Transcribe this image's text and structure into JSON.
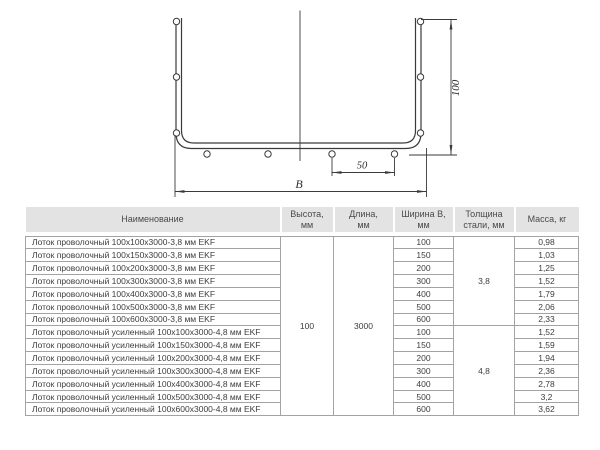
{
  "diagram": {
    "height_label": "100",
    "spacing_label": "50",
    "width_label": "B"
  },
  "table": {
    "headers": {
      "name": "Наименование",
      "height": "Высота,\nмм",
      "length": "Длина,\nмм",
      "width": "Ширина В,\nмм",
      "thickness": "Толщина\nстали, мм",
      "mass": "Масса, кг"
    },
    "shared": {
      "height_mm": "100",
      "length_mm": "3000",
      "thickness_groups": [
        "3,8",
        "4,8"
      ]
    },
    "rows": [
      {
        "name": "Лоток проволочный 100x100x3000-3,8 мм EKF",
        "width": "100",
        "mass": "0,98"
      },
      {
        "name": "Лоток проволочный 100x150x3000-3,8 мм EKF",
        "width": "150",
        "mass": "1,03"
      },
      {
        "name": "Лоток проволочный 100x200x3000-3,8 мм EKF",
        "width": "200",
        "mass": "1,25"
      },
      {
        "name": "Лоток проволочный 100x300x3000-3,8 мм EKF",
        "width": "300",
        "mass": "1,52"
      },
      {
        "name": "Лоток проволочный 100x400x3000-3,8 мм EKF",
        "width": "400",
        "mass": "1,79"
      },
      {
        "name": "Лоток проволочный 100x500x3000-3,8 мм EKF",
        "width": "500",
        "mass": "2,06"
      },
      {
        "name": "Лоток проволочный 100x600x3000-3,8 мм EKF",
        "width": "600",
        "mass": "2,33"
      },
      {
        "name": "Лоток проволочный усиленный 100x100x3000-4,8 мм EKF",
        "width": "100",
        "mass": "1,52"
      },
      {
        "name": "Лоток проволочный усиленный 100x150x3000-4,8 мм EKF",
        "width": "150",
        "mass": "1,59"
      },
      {
        "name": "Лоток проволочный усиленный 100x200x3000-4,8 мм EKF",
        "width": "200",
        "mass": "1,94"
      },
      {
        "name": "Лоток проволочный усиленный 100x300x3000-4,8 мм EKF",
        "width": "300",
        "mass": "2,36"
      },
      {
        "name": "Лоток проволочный усиленный 100x400x3000-4,8 мм EKF",
        "width": "400",
        "mass": "2,78"
      },
      {
        "name": "Лоток проволочный усиленный 100x500x3000-4,8 мм EKF",
        "width": "500",
        "mass": "3,2"
      },
      {
        "name": "Лоток проволочный усиленный 100x600x3000-4,8 мм EKF",
        "width": "600",
        "mass": "3,62"
      }
    ]
  },
  "colors": {
    "header_bg": "#e3e3e3",
    "table_border": "#a3a3a3",
    "text": "#3d3d3d",
    "drawing_line": "#3a3a3a",
    "background": "#ffffff"
  }
}
